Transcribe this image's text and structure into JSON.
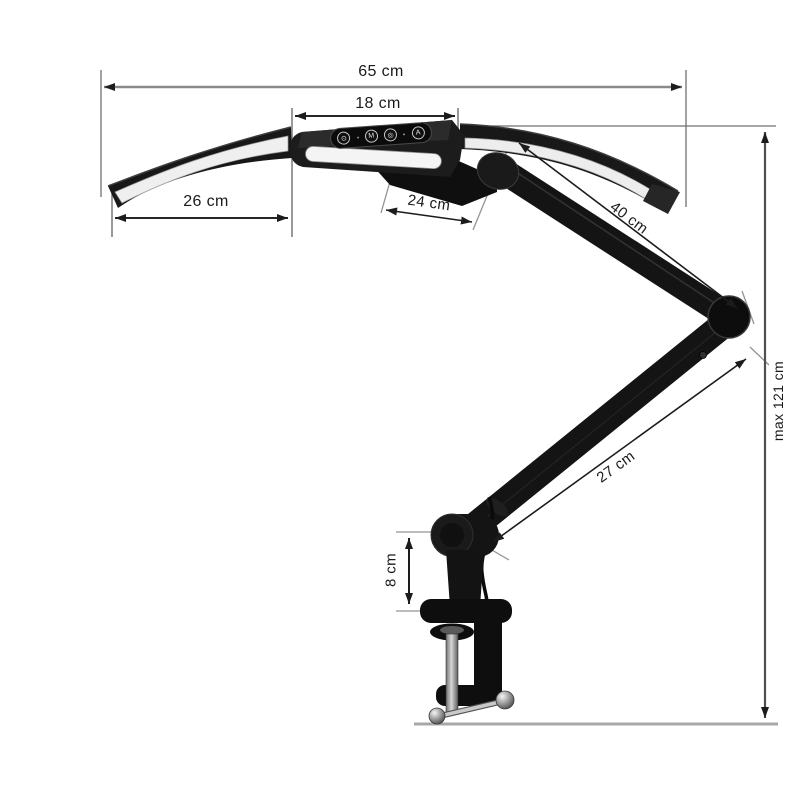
{
  "diagram": {
    "dimension_labels": {
      "total_width": "65 cm",
      "center_width": "18 cm",
      "left_wing_length": "26 cm",
      "head_depth": "24 cm",
      "upper_arm_length": "40 cm",
      "lower_arm_length": "27 cm",
      "clamp_height": "8 cm",
      "max_height": "max 121 cm"
    },
    "control_panel": {
      "buttons": [
        {
          "name": "power-button",
          "glyph": "⊙"
        },
        {
          "name": "mode-button",
          "glyph": "M"
        },
        {
          "name": "brightness-button",
          "glyph": "◎"
        },
        {
          "name": "auto-button",
          "glyph": "A"
        }
      ]
    },
    "colors": {
      "lamp_body": "#151515",
      "led_strip": "#f2f2f2",
      "dimension_line": "#1c1c1c",
      "gray_line": "#8a8a8a",
      "baseline": "#a8a8a8",
      "text": "#1a1a1a"
    }
  }
}
